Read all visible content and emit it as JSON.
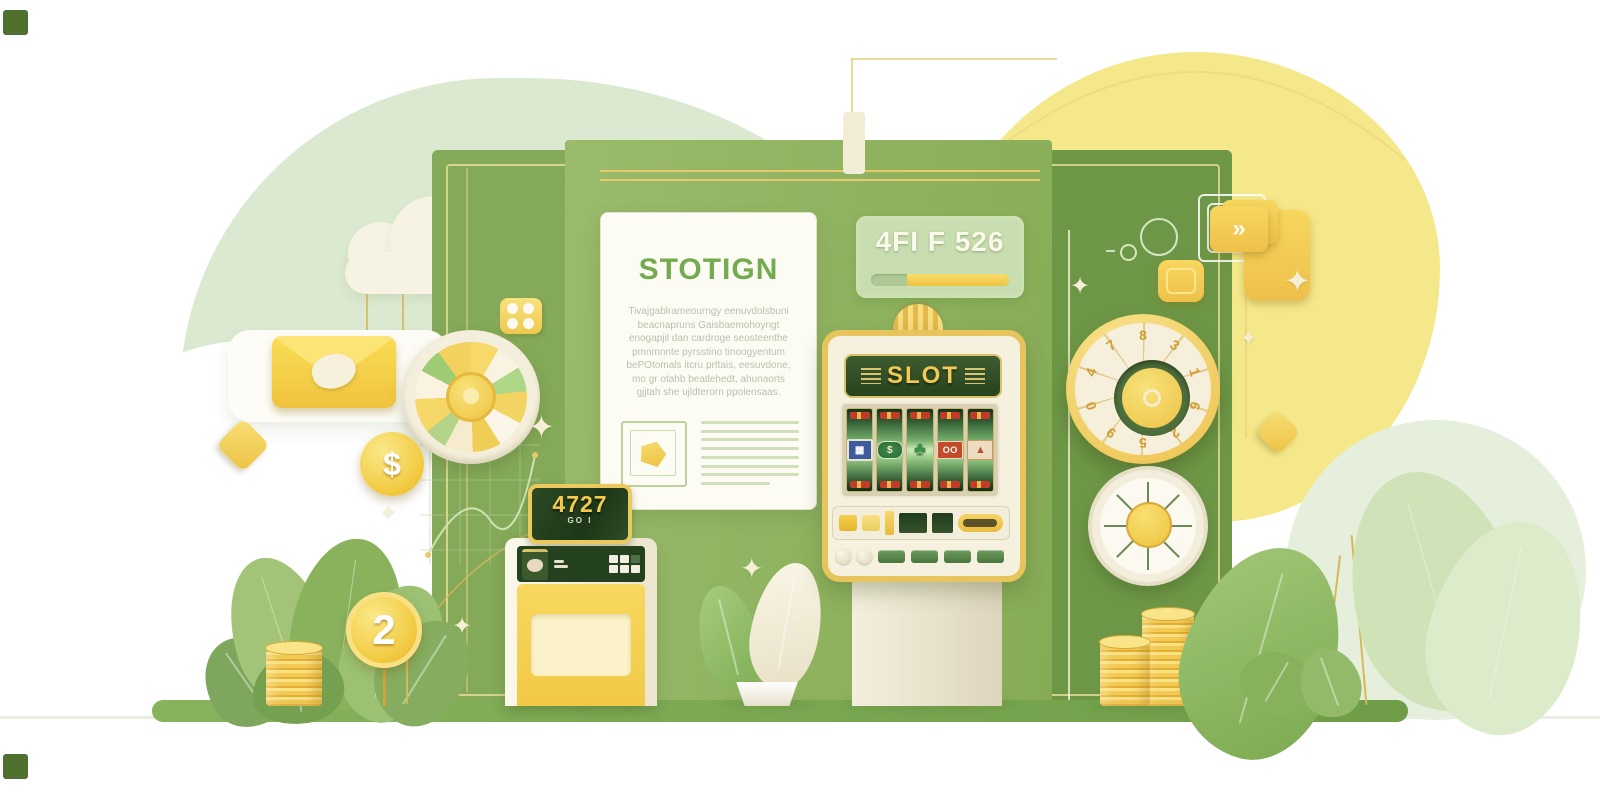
{
  "document": {
    "title": "STOTIGN",
    "body_lines": [
      "Tivajgablrameourngy eenuvdolsbuni",
      "beacnapruns Gaisbaemohoyngt",
      "enogapjil dan cardroge seosteenthe",
      "pmnmnnte pyrsstino tinoogyentum",
      "bePOtomals itcru prttais, eesuvdone,",
      "mo gr otahb beatlehedt, ahunaorts",
      "gjjtah she ujldterorn ppolensaas."
    ]
  },
  "badge": {
    "text": "4FI F 526"
  },
  "slot": {
    "title": "SLOT",
    "reels": [
      {
        "symbol": "ticket",
        "glyph": "▦"
      },
      {
        "symbol": "dollar-badge",
        "glyph": "$"
      },
      {
        "symbol": "clover",
        "glyph": "♣"
      },
      {
        "symbol": "double-o",
        "glyph": "OO"
      },
      {
        "symbol": "mountain",
        "glyph": "▲"
      }
    ]
  },
  "kiosk": {
    "display": "4727",
    "display_sub": "GO I"
  },
  "coins": {
    "dollar": "$",
    "two": "2"
  },
  "dial": {
    "digits": [
      "8",
      "3",
      "1",
      "6",
      "2",
      "5",
      "9",
      "0",
      "4",
      "7"
    ]
  },
  "icons": {
    "chevron": "»",
    "sparkle": "✦"
  },
  "colors": {
    "panel_green": "#84a958",
    "panel_dark_green": "#6d9746",
    "mint_blob": "#dce9d1",
    "yellow_blob": "#f5e88a",
    "gold": "#e7c55c",
    "coin_gold": "#f1c93f",
    "cream": "#f6f1df",
    "slot_screen_green": "#27421d",
    "accent_text_green": "#73ac50"
  }
}
